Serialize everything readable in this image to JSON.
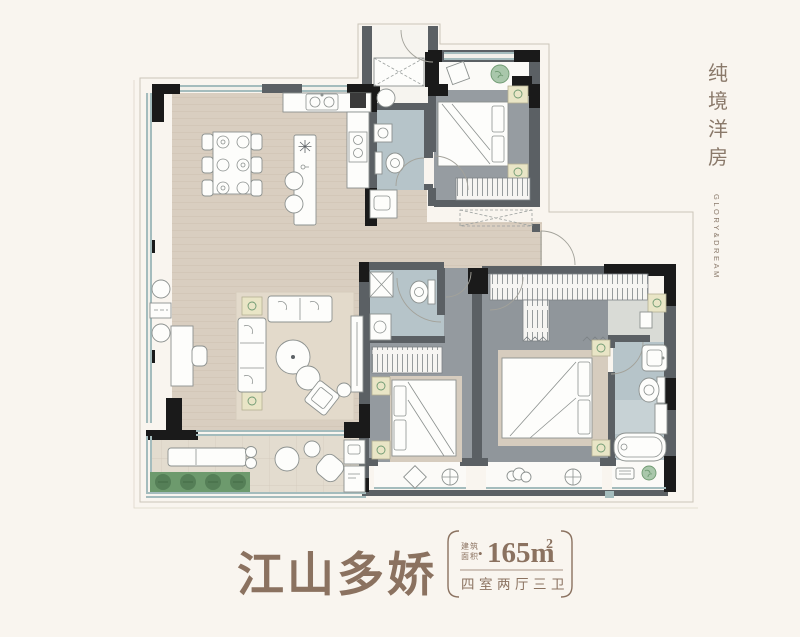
{
  "branding": {
    "chars": [
      "纯",
      "境",
      "洋",
      "房"
    ],
    "subtitle": "GLORY&DREAM"
  },
  "title": {
    "text": "江山多娇"
  },
  "spec": {
    "area_label_top": "建筑",
    "area_label_bottom": "面积",
    "bullet": "•",
    "area_value": "165m",
    "area_sup": "2",
    "layout": "四室两厅三卫"
  },
  "colors": {
    "accent_brown": "#8b7260",
    "brand_brown": "#8a796a",
    "wall_dark": "#1a1a1a",
    "wall_gray": "#5b6064",
    "floor_wood": "#d9cec0",
    "floor_gray": "#949a9f",
    "floor_blue": "#b6c4c9",
    "floor_tile": "#e3dccf",
    "window_teal": "#a4bcbd",
    "plant_green": "#6d9a6d",
    "furniture_accent": "#e9e5c6",
    "background": "#f9f5ef"
  }
}
